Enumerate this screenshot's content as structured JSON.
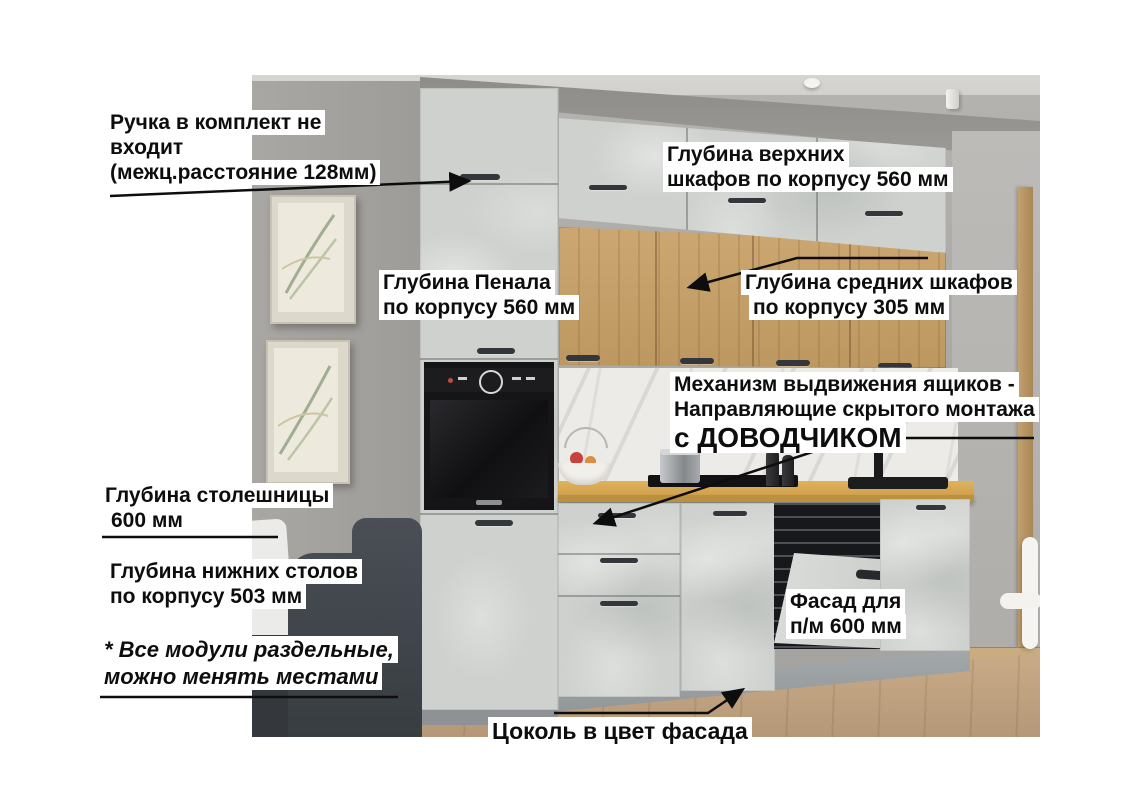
{
  "annotations": {
    "handle_note": {
      "lines": [
        "Ручка в комплект не",
        "входит",
        "(межц.расстояние 128мм)"
      ]
    },
    "upper_cabinets_depth": {
      "lines": [
        "Глубина верхних",
        "шкафов по корпусу 560 мм"
      ]
    },
    "tall_cabinet_depth": {
      "lines": [
        "Глубина Пенала",
        "по корпусу 560 мм"
      ]
    },
    "middle_cabinets_depth": {
      "lines": [
        "Глубина средних шкафов",
        "по корпусу 305 мм"
      ]
    },
    "drawer_mechanism": {
      "lines": [
        "Механизм выдвижения ящиков -",
        "Направляющие скрытого монтажа"
      ],
      "emphasis": "с ДОВОДЧИКОМ"
    },
    "countertop_depth": {
      "lines": [
        "Глубина столешницы",
        "600 мм"
      ]
    },
    "base_cabinets_depth": {
      "lines": [
        "Глубина нижних столов",
        "по корпусу 503 мм"
      ]
    },
    "modules_note": {
      "lines": [
        "* Все модули раздельные,",
        "можно менять местами"
      ]
    },
    "dishwasher_facade": {
      "lines": [
        "Фасад для",
        "п/м 600 мм"
      ]
    },
    "plinth_note": {
      "lines": [
        "Цоколь в цвет фасада"
      ]
    }
  },
  "scene_colors": {
    "annotation_text": "#0d0d0d",
    "annotation_bg": "#ffffff",
    "cabinet_concrete": "#ced1ce",
    "wood_cabinets": "#c49e66",
    "countertop": "#d9a855",
    "wall": "#aeaca8",
    "floor": "#c2a481",
    "plinth": "#9aa0a2",
    "oven": "#151517",
    "sofa": "#43484d",
    "marble_backsplash": "#edebe7"
  }
}
